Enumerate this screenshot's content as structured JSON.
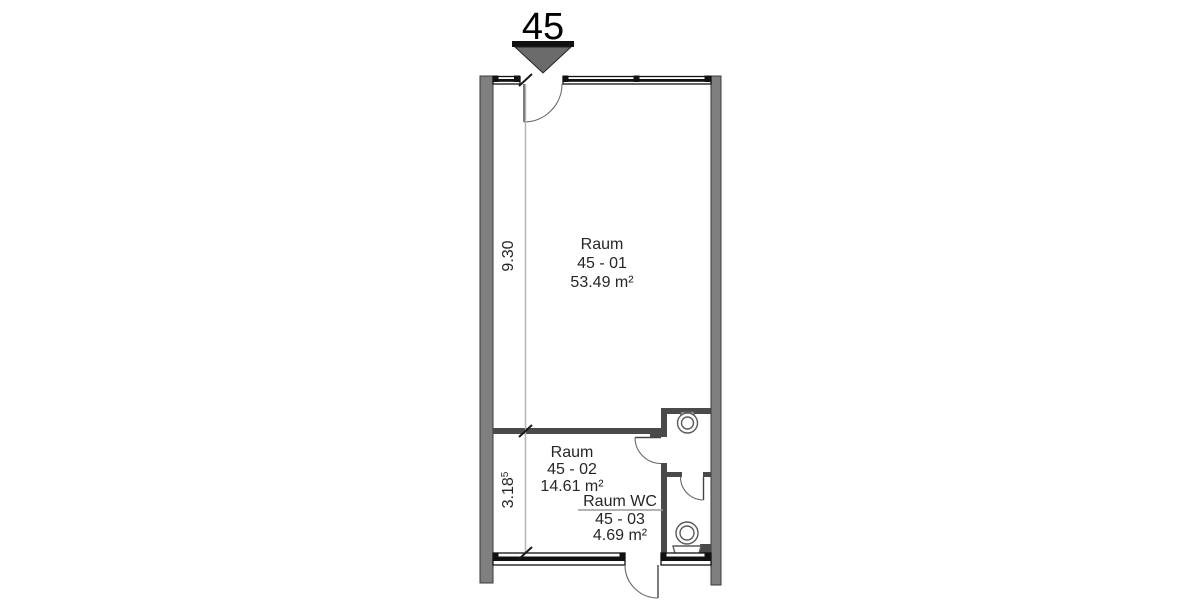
{
  "unit_marker": {
    "number": "45"
  },
  "rooms": {
    "room1": {
      "name": "Raum",
      "number": "45 - 01",
      "area": "53.49 m²"
    },
    "room2": {
      "name": "Raum",
      "number": "45 - 02",
      "area": "14.61 m²"
    },
    "wc": {
      "name": "Raum WC",
      "number": "45 - 03",
      "area": "4.69 m²"
    }
  },
  "dimensions": {
    "vertical_room1": "9.30",
    "vertical_room2": "3.18",
    "vertical_room2_sup": "5"
  },
  "colors": {
    "wall_fill": "#7f7f7f",
    "wall_edge": "#3a3a3a",
    "wall_dark": "#4a4a4a",
    "line_black": "#111111",
    "dimension_line": "#b5b5b5",
    "text": "#262626",
    "marker_fill": "#6b6b6b"
  }
}
